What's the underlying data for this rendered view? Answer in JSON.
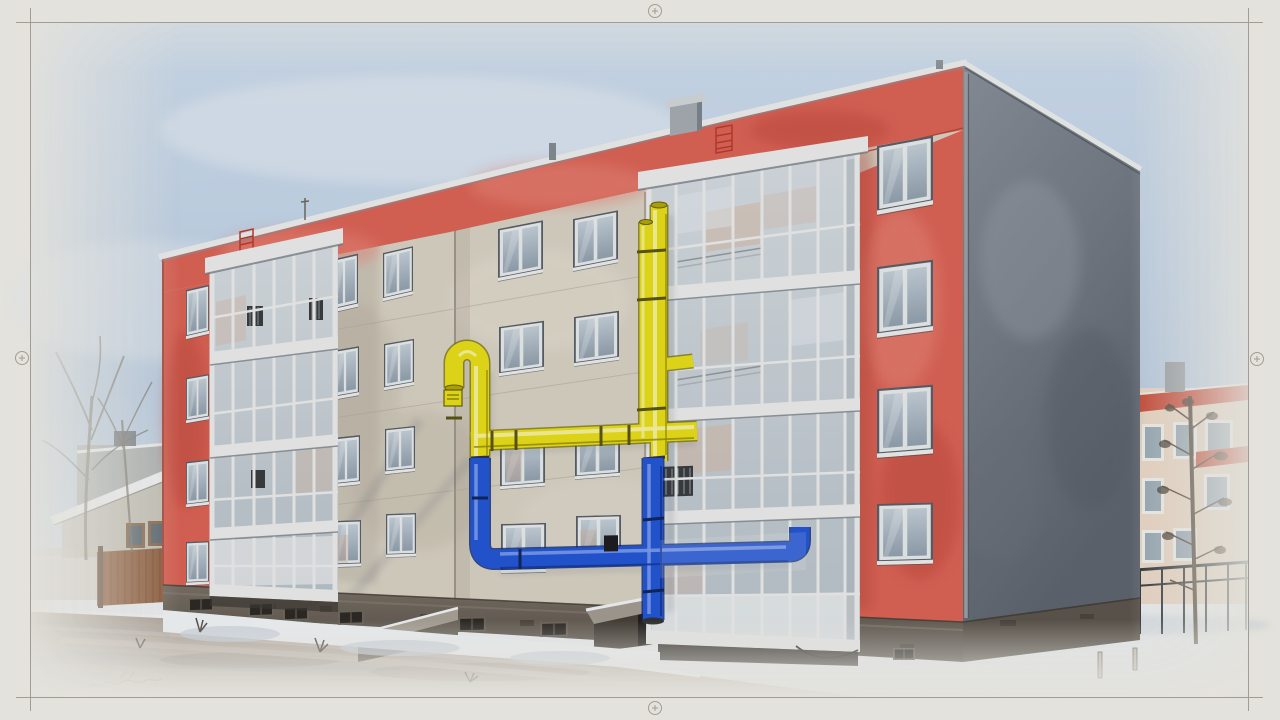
{
  "sheet": {
    "kind": "technical drawing sheet with photo-style rendering",
    "marks": [
      "corner trim lines",
      "registration circle top-center",
      "registration circle bottom-center",
      "registration circle left-edge",
      "registration circle right-edge"
    ],
    "signature_scribble": "illegible pencil squiggle, lower left on road"
  },
  "scene": {
    "subject": "four-storey apartment block in winter with external gas pipeline painted yellow (upper) and blue (lower)",
    "style": "watercolor / colored-pencil filter, bright low winter sun from the right",
    "main_building": {
      "storeys": 4,
      "facade": [
        "red parapet band along roof",
        "red left corner strip with 4 small windows",
        "red right end section with 4 windows",
        "grey stucco field with paired window columns",
        "recessed grey bay carrying the gas pipes",
        "two glazed white-framed loggia columns",
        "windowless blue-grey side gable",
        "dark rubble-stone plinth with basement windows",
        "cellar entrance shed",
        "low stoop ramp",
        "roof chimney and vents",
        "red ladder emblems on parapet"
      ]
    },
    "gas_pipeline": {
      "upper_color": "yellow",
      "lower_color": "blue",
      "parts": [
        "gooseneck vent with meter box",
        "horizontal yellow distribution run with clamps",
        "twin yellow riser with capped tops",
        "branch into right loggia",
        "yellow-to-blue transition collars",
        "blue horizontal run passing behind loggia glazing with end elbow",
        "blue drop to ground",
        "dark service valve"
      ]
    },
    "surroundings": {
      "left": [
        "bare deciduous trees",
        "single-storey house with snowy roof and grey annex",
        "brown plank fence with post"
      ],
      "right": [
        "neighbouring cream block with red roof bands and chimney",
        "young conifer-like tree",
        "dark metal railing",
        "stakes in snow"
      ],
      "foreground": [
        "snow drifts with twigs",
        "wet asphalt road with tyre sheen and tree shadows"
      ]
    }
  },
  "palette": {
    "paper": "#f0efe8",
    "frame_line": "#a29d90",
    "sky_top": "#cfdeee",
    "sky_mid": "#bccfe4",
    "sky_low": "#e2eaf2",
    "wall_grey": "#d9d3c5",
    "wall_grey_dark": "#c1baac",
    "wall_joint": "#b2ab9b",
    "red_main": "#dd6557",
    "red_light": "#ea8a7c",
    "red_dark": "#c24b3f",
    "red_deep": "#b3463a",
    "gable_light": "#8a919b",
    "gable_dark": "#5f6670",
    "coping": "#edefef",
    "plinth_top": "#7a7166",
    "plinth_dark": "#544e46",
    "stone": "#5d564e",
    "balcony_frame": "#eceeec",
    "glass_top": "#d7dee3",
    "glass_bottom": "#b9c3cb",
    "glass_warm": "#d8b9a4",
    "glass_frost": "#eef0f0",
    "win_frame": "#e9ecec",
    "win_glass_top": "#c5d0d9",
    "win_glass_bottom": "#93a2b0",
    "win_outline": "#59616b",
    "pipe_yellow": "#e9e01b",
    "pipe_yellow_hi": "#f9f5a6",
    "pipe_yellow_dark": "#958b06",
    "pipe_yellow_deep": "#7a7206",
    "pipe_yellow_cap": "#b3a80c",
    "pipe_blue": "#2457d6",
    "pipe_blue_hi": "#7d9ff0",
    "pipe_blue_dark": "#163b9e",
    "pipe_blue_deep": "#0e2a75",
    "snow": "#eef1f4",
    "snow_shadow": "#ccd6e0",
    "road_dark": "#b0a498",
    "road_light": "#cfc8bf",
    "house_wall": "#c8c5ba",
    "house_block": "#b2b6b5",
    "fence_brown": "#925f3e",
    "fence_dark": "#744a2b",
    "bg_wall": "#ecd9c6",
    "bg_roof": "#cb4b38",
    "bg_glass": "#97a8b5",
    "tree_dark": "#4a3e32",
    "tree_pale": "#7b7568",
    "railing": "#2e3338",
    "twig": "#57504a",
    "basement": "#2e2b27",
    "shed_dark": "#474139",
    "vignette": "#f0efe9"
  }
}
